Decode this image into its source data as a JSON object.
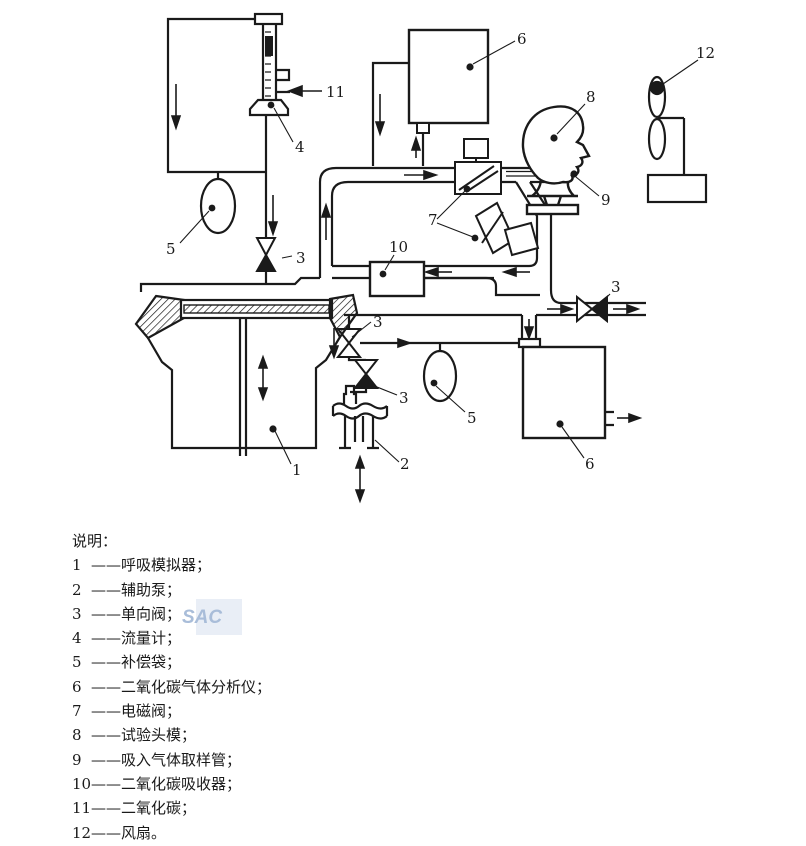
{
  "figure": {
    "callouts": {
      "breathing_simulator": "1",
      "auxiliary_pump": "2",
      "check_valve": "3",
      "flow_meter": "4",
      "compensation_bag": "5",
      "co2_analyzer": "6",
      "solenoid_valve": "7",
      "test_head": "8",
      "sampling_tube": "9",
      "co2_absorber": "10",
      "co2": "11",
      "fan": "12"
    },
    "watermark": "SAC"
  },
  "legend": {
    "title": "说明：",
    "items": [
      {
        "num": "1",
        "label": "——呼吸模拟器；"
      },
      {
        "num": "2",
        "label": "——辅助泵；"
      },
      {
        "num": "3",
        "label": "——单向阀；"
      },
      {
        "num": "4",
        "label": "——流量计；"
      },
      {
        "num": "5",
        "label": "——补偿袋；"
      },
      {
        "num": "6",
        "label": "——二氧化碳气体分析仪；"
      },
      {
        "num": "7",
        "label": "——电磁阀；"
      },
      {
        "num": "8",
        "label": "——试验头模；"
      },
      {
        "num": "9",
        "label": "——吸入气体取样管；"
      },
      {
        "num": "10",
        "label": "——二氧化碳吸收器；"
      },
      {
        "num": "11",
        "label": "——二氧化碳；"
      },
      {
        "num": "12",
        "label": "——风扇。"
      }
    ]
  }
}
